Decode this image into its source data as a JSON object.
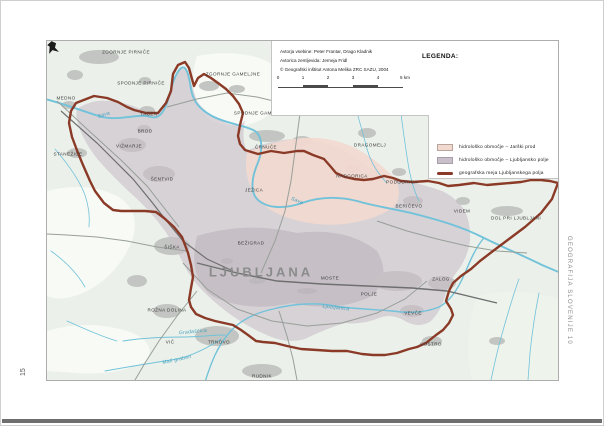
{
  "page": {
    "number": "15",
    "side_title": "GEOGRAFIJA SLOVENIJE 10"
  },
  "map": {
    "credits": [
      "Avtorja vsebine: Peter Frantar, Drago Kladnik",
      "Avtorica zemljevida: Jerneja Fridl",
      "© Geografski inštitut Antona Melika ZRC SAZU, 2004"
    ],
    "legend": {
      "title": "LEGENDA:",
      "items": [
        {
          "type": "area",
          "color": "#f2d9cf",
          "border": "#b9a49b",
          "label": "hidrološko območje – Jarški prod"
        },
        {
          "type": "area",
          "color": "#c9bfca",
          "border": "#a89eaa",
          "label": "hidrološko območje – Ljubljansko polje"
        },
        {
          "type": "line",
          "color": "#8a3a27",
          "label": "geografska meja Ljubljanskega polja"
        }
      ]
    },
    "scale_bar": {
      "tick_labels": [
        "0",
        "1",
        "2",
        "3",
        "4"
      ],
      "end_label": "5 km",
      "step_px": 25
    },
    "colors": {
      "boundary": "#8a3a27",
      "river": "#72c2da",
      "urban": "#c2c5c1",
      "zone_ljubljansko_polje": "#c9bfca",
      "zone_jarski_prod": "#f2d9cf",
      "base": "#ebf1ea"
    },
    "labels": [
      {
        "t": "ZGORNJE PIRNIČE",
        "x": 79,
        "y": 11,
        "k": "t"
      },
      {
        "t": "SPODNJE PIRNIČE",
        "x": 94,
        "y": 42,
        "k": "t"
      },
      {
        "t": "ZGORNJE GAMELJNE",
        "x": 186,
        "y": 33,
        "k": "t"
      },
      {
        "t": "MEDNO",
        "x": 19,
        "y": 57,
        "k": "t"
      },
      {
        "t": "SPODNJE GAMELJNE",
        "x": 214,
        "y": 72,
        "k": "t"
      },
      {
        "t": "TACEN",
        "x": 102,
        "y": 73,
        "k": "t"
      },
      {
        "t": "BROD",
        "x": 98,
        "y": 90,
        "k": "t"
      },
      {
        "t": "VIŽMARJE",
        "x": 82,
        "y": 105,
        "k": "t"
      },
      {
        "t": "STANEŽIČE",
        "x": 21,
        "y": 113,
        "k": "t"
      },
      {
        "t": "ŠENTVID",
        "x": 115,
        "y": 138,
        "k": "t"
      },
      {
        "t": "ČRNUČE",
        "x": 219,
        "y": 106,
        "k": "t"
      },
      {
        "t": "DRAGOMELJ",
        "x": 323,
        "y": 104,
        "k": "t"
      },
      {
        "t": "NADGORICA",
        "x": 305,
        "y": 135,
        "k": "t"
      },
      {
        "t": "JEŽICA",
        "x": 207,
        "y": 149,
        "k": "t"
      },
      {
        "t": "PODGORICA",
        "x": 355,
        "y": 141,
        "k": "t"
      },
      {
        "t": "BERIČEVO",
        "x": 362,
        "y": 165,
        "k": "t"
      },
      {
        "t": "VIDEM",
        "x": 415,
        "y": 170,
        "k": "t"
      },
      {
        "t": "DOL PRI LJUBLJANI",
        "x": 469,
        "y": 177,
        "k": "t"
      },
      {
        "t": "BEŽIGRAD",
        "x": 204,
        "y": 202,
        "k": "t"
      },
      {
        "t": "LJUBLJANA",
        "x": 214,
        "y": 231,
        "k": "b"
      },
      {
        "t": "MOSTE",
        "x": 283,
        "y": 237,
        "k": "t"
      },
      {
        "t": "POLJE",
        "x": 322,
        "y": 253,
        "k": "t"
      },
      {
        "t": "ZALOG",
        "x": 394,
        "y": 238,
        "k": "t"
      },
      {
        "t": "VEVČE",
        "x": 366,
        "y": 272,
        "k": "t"
      },
      {
        "t": "SOSTRO",
        "x": 384,
        "y": 303,
        "k": "t"
      },
      {
        "t": "ŠIŠKA",
        "x": 125,
        "y": 206,
        "k": "t"
      },
      {
        "t": "ROŽNA DOLINA",
        "x": 120,
        "y": 269,
        "k": "t"
      },
      {
        "t": "VIČ",
        "x": 123,
        "y": 301,
        "k": "t"
      },
      {
        "t": "TRNOVO",
        "x": 172,
        "y": 301,
        "k": "t"
      },
      {
        "t": "RUDNIK",
        "x": 215,
        "y": 335,
        "k": "t"
      },
      {
        "t": "Sava",
        "x": 57,
        "y": 74,
        "k": "r",
        "r": -18
      },
      {
        "t": "Sava",
        "x": 250,
        "y": 160,
        "k": "r",
        "r": 22
      },
      {
        "t": "Ljubljanica",
        "x": 289,
        "y": 267,
        "k": "r",
        "r": 6
      },
      {
        "t": "Gradaščica",
        "x": 146,
        "y": 291,
        "k": "r",
        "r": -5
      },
      {
        "t": "Mali graben",
        "x": 130,
        "y": 319,
        "k": "r",
        "r": -12
      }
    ]
  }
}
